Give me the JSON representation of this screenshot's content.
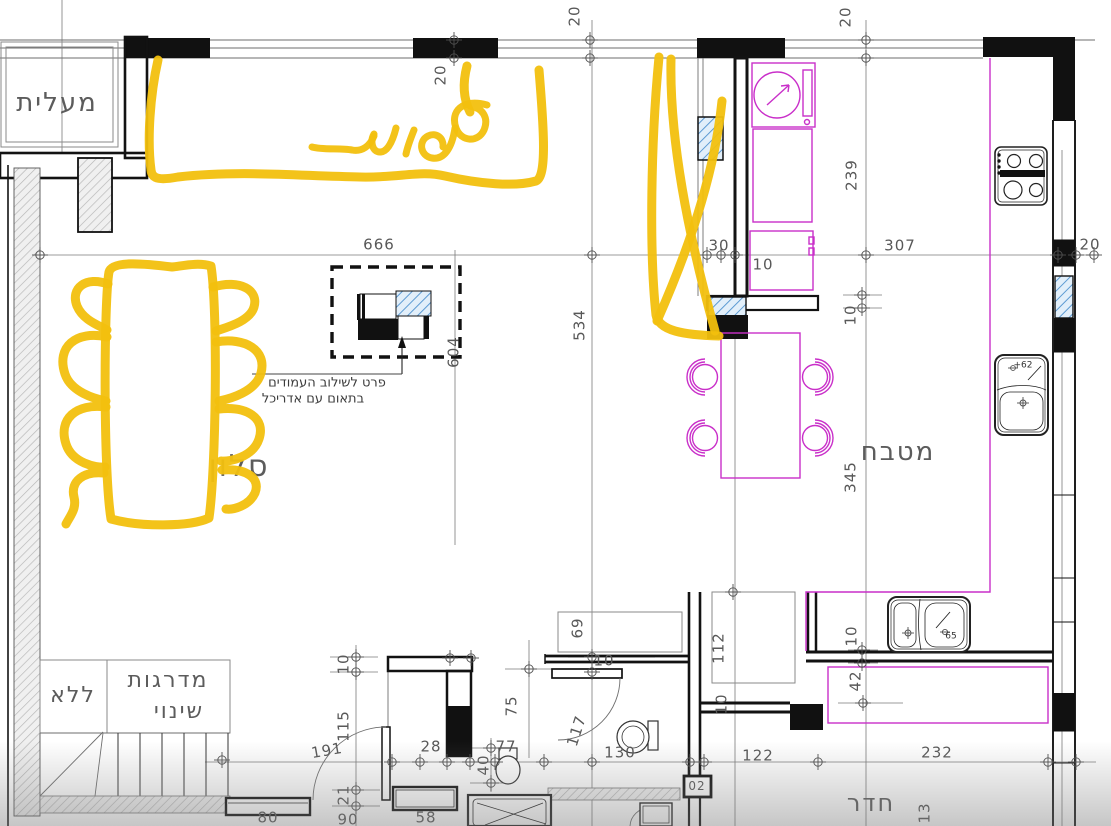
{
  "palette": {
    "marker": "#f2c00e",
    "magenta": "#c92fc9",
    "hatch-blue": "#5d9bd3",
    "dim-text": "#565656",
    "wall": "#121212"
  },
  "annotations": {
    "handwritten_word": "ספות",
    "marker_color": "#f2c00e",
    "shapes": [
      "sofa-zone-outline-top",
      "dining-table-scribble-left",
      "x-mark-over-kitchen-passage"
    ]
  },
  "detail_note": {
    "line1": "פרט לשילוב העמודים",
    "line2": "בתאום עם אדריכל"
  },
  "labels": [
    {
      "t": "מעלית",
      "x": 57,
      "y": 103,
      "c": "room"
    },
    {
      "t": "סלון",
      "x": 239,
      "y": 467,
      "c": "room",
      "s": 30
    },
    {
      "t": "מטבח",
      "x": 898,
      "y": 452,
      "c": "room"
    },
    {
      "t": "חדר",
      "x": 871,
      "y": 803,
      "c": "room",
      "s": 24
    },
    {
      "t": "ללא",
      "x": 73,
      "y": 696,
      "c": "room",
      "s": 22
    },
    {
      "t": "מדרגות",
      "x": 168,
      "y": 681,
      "c": "room",
      "s": 22
    },
    {
      "t": "שינוי",
      "x": 179,
      "y": 712,
      "c": "room",
      "s": 22
    },
    {
      "t": "פרט לשילוב העמודים",
      "x": 327,
      "y": 383,
      "c": "note"
    },
    {
      "t": "בתאום עם אדריכל",
      "x": 313,
      "y": 399,
      "c": "note"
    },
    {
      "t": "20",
      "x": 441,
      "y": 75,
      "r": -90,
      "c": "dim"
    },
    {
      "t": "20",
      "x": 575,
      "y": 16,
      "r": -90,
      "c": "dim"
    },
    {
      "t": "20",
      "x": 846,
      "y": 17,
      "r": -90,
      "c": "dim"
    },
    {
      "t": "666",
      "x": 379,
      "y": 245,
      "c": "dim"
    },
    {
      "t": "30",
      "x": 719,
      "y": 246,
      "c": "dim"
    },
    {
      "t": "10",
      "x": 763,
      "y": 265,
      "c": "dim"
    },
    {
      "t": "307",
      "x": 900,
      "y": 246,
      "c": "dim"
    },
    {
      "t": "20",
      "x": 1090,
      "y": 245,
      "c": "dim"
    },
    {
      "t": "239",
      "x": 852,
      "y": 175,
      "r": -90,
      "c": "dim"
    },
    {
      "t": "534",
      "x": 580,
      "y": 325,
      "r": -90,
      "c": "dim"
    },
    {
      "t": "604",
      "x": 454,
      "y": 352,
      "r": -90,
      "c": "dim"
    },
    {
      "t": "10",
      "x": 851,
      "y": 315,
      "r": -90,
      "c": "dim"
    },
    {
      "t": "345",
      "x": 851,
      "y": 477,
      "r": -90,
      "c": "dim"
    },
    {
      "t": "69",
      "x": 578,
      "y": 628,
      "r": -90,
      "c": "dim"
    },
    {
      "t": "112",
      "x": 719,
      "y": 648,
      "r": -90,
      "c": "dim"
    },
    {
      "t": "10",
      "x": 344,
      "y": 664,
      "r": -90,
      "c": "dim"
    },
    {
      "t": "10",
      "x": 604,
      "y": 661,
      "c": "dim"
    },
    {
      "t": "10",
      "x": 722,
      "y": 704,
      "r": -90,
      "c": "dim"
    },
    {
      "t": "10",
      "x": 852,
      "y": 636,
      "r": -90,
      "c": "dim"
    },
    {
      "t": "42",
      "x": 856,
      "y": 681,
      "r": -90,
      "c": "dim"
    },
    {
      "t": "115",
      "x": 344,
      "y": 726,
      "r": -90,
      "c": "dim"
    },
    {
      "t": "191",
      "x": 327,
      "y": 751,
      "r": -10,
      "c": "dim"
    },
    {
      "t": "28",
      "x": 431,
      "y": 747,
      "c": "dim"
    },
    {
      "t": "40",
      "x": 484,
      "y": 765,
      "r": -90,
      "c": "dim"
    },
    {
      "t": "77",
      "x": 506,
      "y": 747,
      "c": "dim"
    },
    {
      "t": "75",
      "x": 512,
      "y": 706,
      "r": -90,
      "c": "dim"
    },
    {
      "t": "117",
      "x": 577,
      "y": 731,
      "r": -72,
      "c": "dim"
    },
    {
      "t": "130",
      "x": 620,
      "y": 753,
      "c": "dim"
    },
    {
      "t": "122",
      "x": 758,
      "y": 756,
      "c": "dim"
    },
    {
      "t": "232",
      "x": 937,
      "y": 753,
      "c": "dim"
    },
    {
      "t": "21",
      "x": 344,
      "y": 795,
      "r": -90,
      "c": "dim"
    },
    {
      "t": "90",
      "x": 348,
      "y": 820,
      "c": "dim"
    },
    {
      "t": "80",
      "x": 268,
      "y": 818,
      "c": "dim"
    },
    {
      "t": "58",
      "x": 426,
      "y": 818,
      "c": "dim"
    },
    {
      "t": "13",
      "x": 925,
      "y": 813,
      "r": -90,
      "c": "dim"
    },
    {
      "t": "02",
      "x": 697,
      "y": 786,
      "c": "dim",
      "s": 12
    },
    {
      "t": "+62",
      "x": 1023,
      "y": 366,
      "c": "tiny"
    },
    {
      "t": "65",
      "x": 951,
      "y": 637,
      "c": "tiny"
    }
  ]
}
